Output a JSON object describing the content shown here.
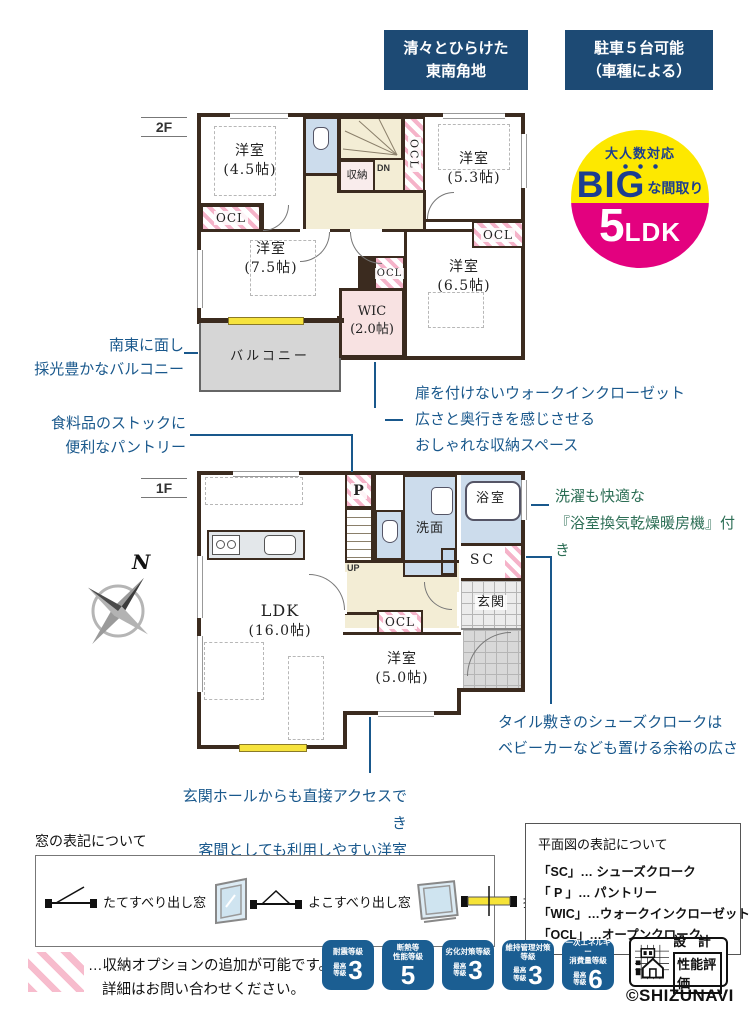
{
  "banners": [
    {
      "line1": "清々とひらけた",
      "line2": "東南角地"
    },
    {
      "line1": "駐車５台可能",
      "line2": "（車種による）"
    }
  ],
  "big_badge": {
    "catch": "大人数対応",
    "big": "BIG",
    "tail": "な間取り",
    "num": "5",
    "unit": "LDK"
  },
  "floors": {
    "f2": "2F",
    "f1": "1F"
  },
  "rooms2f": {
    "r45": {
      "name": "洋室",
      "size": "(4.5帖)"
    },
    "r53": {
      "name": "洋室",
      "size": "(5.3帖)"
    },
    "r75": {
      "name": "洋室",
      "size": "(7.5帖)"
    },
    "r65": {
      "name": "洋室",
      "size": "(6.5帖)"
    },
    "wic": {
      "name": "WIC",
      "size": "(2.0帖)"
    },
    "shuno": "収納",
    "dn": "DN",
    "ocl": "OCL",
    "balcony": "バルコニー"
  },
  "rooms1f": {
    "ldk": {
      "name": "LDK",
      "size": "(16.0帖)"
    },
    "r50": {
      "name": "洋室",
      "size": "(5.0帖)"
    },
    "senmen": "洗面",
    "bath": "浴室",
    "sc": "SC",
    "genkan": "玄関",
    "pantry": "P",
    "up": "UP",
    "ocl": "OCL"
  },
  "annotations": {
    "balcony": {
      "lines": [
        "南東に面し",
        "採光豊かなバルコニー"
      ]
    },
    "pantry": {
      "lines": [
        "食料品のストックに",
        "便利なパントリー"
      ]
    },
    "wic": {
      "lines": [
        "扉を付けないウォークインクローゼット",
        "広さと奥行きを感じさせる",
        "おしゃれな収納スペース"
      ]
    },
    "bath": {
      "lines": [
        "洗濯も快適な",
        "『浴室換気乾燥暖房機』付き"
      ]
    },
    "shoecloak": {
      "lines": [
        "タイル敷きのシューズクロークは",
        "ベビーカーなども置ける余裕の広さ"
      ]
    },
    "guest": {
      "lines": [
        "玄関ホールからも直接アクセスでき",
        "客間としても利用しやすい洋室"
      ]
    }
  },
  "compass_label": "N",
  "window_legend": {
    "title": "窓の表記について",
    "items": [
      "たてすべり出し窓",
      "よこすべり出し窓",
      "掃き出し窓"
    ]
  },
  "plan_legend": {
    "title": "平面図の表記について",
    "items": [
      {
        "code": "「SC」",
        "desc": "… シューズクローク"
      },
      {
        "code": "「 P 」",
        "desc": "… パントリー"
      },
      {
        "code": "「WIC」",
        "desc": "…ウォークインクローゼット"
      },
      {
        "code": "「OCL」",
        "desc": "…オープンクローク"
      }
    ]
  },
  "note": {
    "lines": [
      "…収納オプションの追加が可能です。",
      "詳細はお問い合わせください。"
    ]
  },
  "perf_badges": [
    {
      "t1": "耐震等級",
      "t2": "",
      "p1": "最高",
      "p2": "等級",
      "value": "3"
    },
    {
      "t1": "断熱等",
      "t2": "性能等級",
      "p1": "",
      "p2": "",
      "value": "5"
    },
    {
      "t1": "劣化対策等級",
      "t2": "",
      "p1": "最高",
      "p2": "等級",
      "value": "3"
    },
    {
      "t1": "維持管理対策",
      "t2": "等級",
      "p1": "最高",
      "p2": "等級",
      "value": "3"
    },
    {
      "t1": "一次エネルギー",
      "t2": "消費量等級",
      "p1": "最高",
      "p2": "等級",
      "value": "6"
    }
  ],
  "cert_logo": {
    "line1": "設 計",
    "line2": "性能評価"
  },
  "copyright": "©SHIZUNAVI",
  "colors": {
    "navy": "#1d4a74",
    "badge_blue": "#1b5e92",
    "yellow": "#fde800",
    "magenta": "#e3017f",
    "annotation_blue": "#19588c",
    "annotation_green": "#2c6e55",
    "hatch_pink": "#f5b3c9"
  }
}
